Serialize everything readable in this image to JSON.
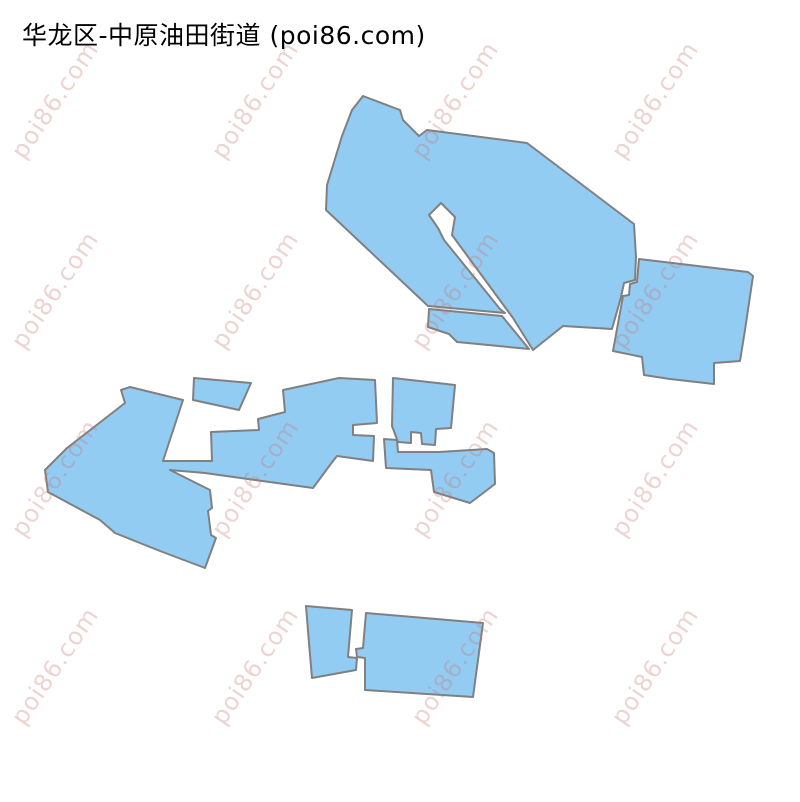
{
  "title": "华龙区-中原油田街道 (poi86.com)",
  "map": {
    "background_color": "#ffffff",
    "fill_color": "#93ccf2",
    "stroke_color": "#808080",
    "stroke_width": 2,
    "polygons": [
      {
        "name": "boundary-north-main",
        "points": [
          [
            363,
            96
          ],
          [
            400,
            110
          ],
          [
            403,
            120
          ],
          [
            419,
            136
          ],
          [
            427,
            130
          ],
          [
            527,
            143
          ],
          [
            634,
            224
          ],
          [
            636,
            257
          ],
          [
            635,
            280
          ],
          [
            624,
            283
          ],
          [
            621,
            297
          ],
          [
            612,
            329
          ],
          [
            563,
            326
          ],
          [
            533,
            350
          ],
          [
            513,
            318
          ],
          [
            452,
            235
          ],
          [
            455,
            217
          ],
          [
            441,
            203
          ],
          [
            429,
            215
          ],
          [
            438,
            228
          ],
          [
            444,
            240
          ],
          [
            500,
            309
          ],
          [
            505,
            313
          ],
          [
            428,
            306
          ],
          [
            326,
            210
          ],
          [
            327,
            185
          ],
          [
            342,
            136
          ],
          [
            352,
            110
          ]
        ]
      },
      {
        "name": "boundary-north-east",
        "points": [
          [
            639,
            259
          ],
          [
            748,
            272
          ],
          [
            753,
            276
          ],
          [
            745,
            330
          ],
          [
            740,
            361
          ],
          [
            714,
            363
          ],
          [
            714,
            384
          ],
          [
            670,
            379
          ],
          [
            644,
            375
          ],
          [
            642,
            357
          ],
          [
            613,
            351
          ],
          [
            623,
            296
          ],
          [
            629,
            295
          ],
          [
            630,
            284
          ],
          [
            637,
            282
          ]
        ]
      },
      {
        "name": "boundary-north-southwest",
        "points": [
          [
            429,
            309
          ],
          [
            502,
            316
          ],
          [
            529,
            349
          ],
          [
            457,
            342
          ],
          [
            449,
            334
          ],
          [
            428,
            327
          ]
        ]
      },
      {
        "name": "boundary-middle-trapezoid",
        "points": [
          [
            194,
            378
          ],
          [
            251,
            383
          ],
          [
            239,
            410
          ],
          [
            193,
            400
          ]
        ]
      },
      {
        "name": "boundary-middle-main",
        "points": [
          [
            130,
            387
          ],
          [
            183,
            400
          ],
          [
            163,
            461
          ],
          [
            204,
            461
          ],
          [
            212,
            461
          ],
          [
            211,
            432
          ],
          [
            259,
            430
          ],
          [
            258,
            419
          ],
          [
            285,
            412
          ],
          [
            283,
            390
          ],
          [
            339,
            378
          ],
          [
            375,
            380
          ],
          [
            377,
            423
          ],
          [
            353,
            425
          ],
          [
            353,
            435
          ],
          [
            374,
            436
          ],
          [
            373,
            461
          ],
          [
            337,
            456
          ],
          [
            330,
            465
          ],
          [
            313,
            488
          ],
          [
            255,
            480
          ],
          [
            205,
            473
          ],
          [
            170,
            470
          ],
          [
            210,
            490
          ],
          [
            212,
            508
          ],
          [
            208,
            511
          ],
          [
            211,
            535
          ],
          [
            216,
            538
          ],
          [
            205,
            568
          ],
          [
            160,
            551
          ],
          [
            115,
            533
          ],
          [
            100,
            520
          ],
          [
            48,
            492
          ],
          [
            45,
            470
          ],
          [
            67,
            448
          ],
          [
            125,
            403
          ],
          [
            121,
            390
          ]
        ]
      },
      {
        "name": "boundary-middle-south",
        "points": [
          [
            384,
            439
          ],
          [
            397,
            440
          ],
          [
            398,
            452
          ],
          [
            439,
            452
          ],
          [
            487,
            449
          ],
          [
            494,
            453
          ],
          [
            495,
            484
          ],
          [
            470,
            503
          ],
          [
            434,
            492
          ],
          [
            431,
            470
          ],
          [
            386,
            468
          ]
        ]
      },
      {
        "name": "boundary-middle-east-rect",
        "points": [
          [
            393,
            378
          ],
          [
            455,
            385
          ],
          [
            451,
            428
          ],
          [
            436,
            429
          ],
          [
            435,
            445
          ],
          [
            422,
            444
          ],
          [
            421,
            433
          ],
          [
            411,
            432
          ],
          [
            411,
            443
          ],
          [
            398,
            442
          ],
          [
            392,
            426
          ]
        ]
      },
      {
        "name": "boundary-south-left",
        "points": [
          [
            306,
            606
          ],
          [
            352,
            610
          ],
          [
            348,
            657
          ],
          [
            357,
            658
          ],
          [
            356,
            670
          ],
          [
            312,
            678
          ],
          [
            309,
            643
          ]
        ]
      },
      {
        "name": "boundary-south-right",
        "points": [
          [
            366,
            613
          ],
          [
            483,
            623
          ],
          [
            478,
            660
          ],
          [
            473,
            697
          ],
          [
            365,
            690
          ],
          [
            365,
            658
          ],
          [
            357,
            657
          ],
          [
            356,
            649
          ],
          [
            363,
            648
          ]
        ]
      }
    ]
  },
  "watermark": {
    "text": "poi86.com",
    "color": "rgba(199,119,112,0.32)",
    "font_size_px": 24,
    "rotation_deg": -56,
    "columns_x": [
      55,
      255,
      455,
      655
    ],
    "rows_y": [
      100,
      290,
      478,
      666
    ]
  }
}
